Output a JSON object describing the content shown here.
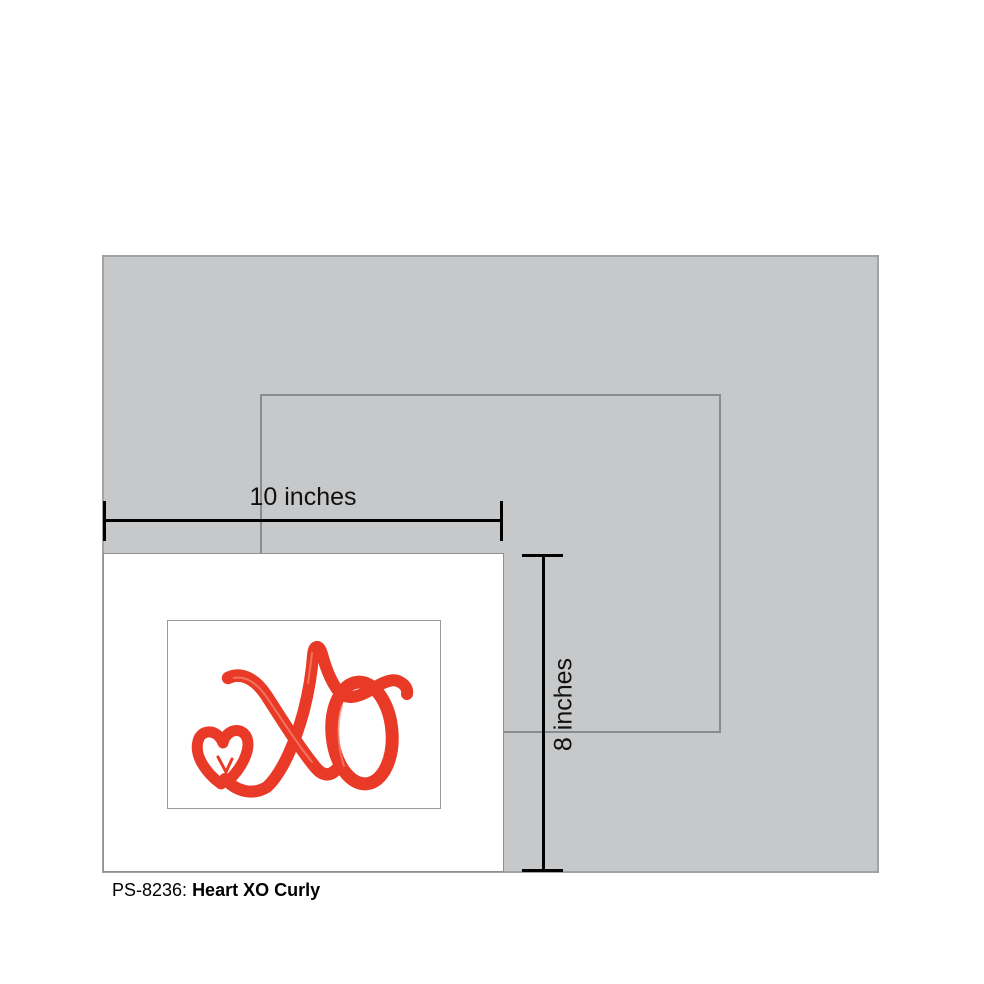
{
  "diagram": {
    "width_label": "10 inches",
    "height_label": "8 inches"
  },
  "caption": {
    "sku": "PS-8236:",
    "title": "Heart XO Curly"
  },
  "colors": {
    "panel_gray": "#c7c8c9",
    "panel_border": "#a2a3a4",
    "frame_outline": "#8a8b8c",
    "card_border": "#8f9091",
    "mat_border": "#9a9b9c",
    "measure_line": "#000000",
    "art_red": "#e93a28",
    "art_red_light": "#f58a74"
  },
  "art": {
    "name": "heart-xo-curly",
    "elements": [
      "heart",
      "cursive-x",
      "cursive-o",
      "right-flourish"
    ]
  }
}
